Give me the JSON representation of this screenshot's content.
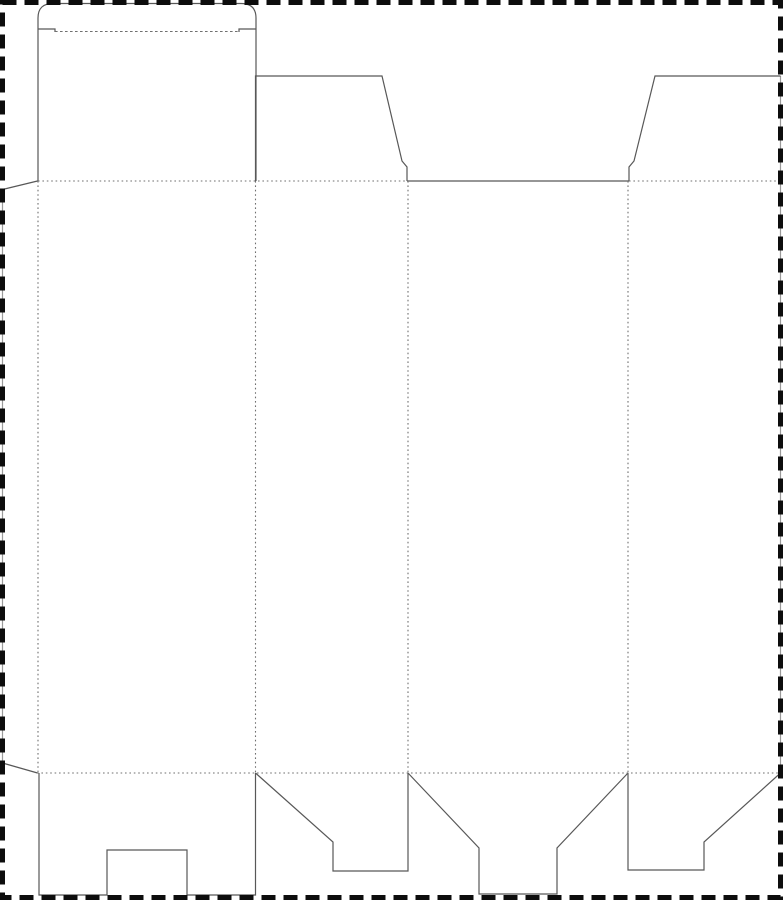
{
  "document": {
    "kind": "folding-carton-dieline-template",
    "description": "Blank box dieline: tuck-top lid with glue flap, four panels, dust flaps and notched bottom flap, surrounded by a dashed cut border"
  },
  "canvas": {
    "width": 783,
    "height": 900,
    "background": "#ffffff"
  },
  "styles": {
    "cut_color": "#585858",
    "cut_width": 1.2,
    "fold_color": "#6f6f6f",
    "fold_width": 1.1,
    "fold_dash": "1.6 2.8",
    "tuck_fold_dash": "2.6 2.4",
    "clipped_color": "#9a9a9a",
    "clipped_width": 1.2,
    "border_color": "#0d0d0d",
    "border_width": 5,
    "border_dash": "14 8"
  },
  "border": {
    "x": 2.5,
    "y": 2.5,
    "width": 778,
    "height": 895
  },
  "clipped_edges": [
    {
      "name": "glue-flap-clipped-left-edge",
      "d": "M 2.5 189 L 2.5 763"
    },
    {
      "name": "right-panel-clipped-edge",
      "d": "M 780.5 76 L 780.5 773"
    }
  ],
  "cut_paths": [
    {
      "name": "tuck-lid-outline",
      "d": "M 38 181 L 38 18 Q 38 3.5 53 3.5 L 241 3.5 Q 256 3.5 256 18 L 256 181"
    },
    {
      "name": "tuck-shoulder-left",
      "d": "M 38 29 L 55 29 L 55 32"
    },
    {
      "name": "tuck-shoulder-right",
      "d": "M 239 32 L 239 29 L 256 29"
    },
    {
      "name": "glue-flap-top-edge",
      "d": "M 2.5 189.5 L 37.5 181"
    },
    {
      "name": "glue-flap-bottom-edge",
      "d": "M 2.5 763 L 37.5 773"
    },
    {
      "name": "top-dust-flap-left",
      "d": "M 255.5 181 L 255.5 76 L 382 76 L 402 161 L 407 167 L 407 181"
    },
    {
      "name": "back-panel-top-cut-edge",
      "d": "M 407 181 L 629 181"
    },
    {
      "name": "top-dust-flap-right",
      "d": "M 629 181 L 629 167 L 634 161 L 655 76 L 780.5 76"
    },
    {
      "name": "bottom-flap-notched",
      "d": "M 39 773 L 39 895 L 107 895 L 107 850 L 187 850 L 187 895 L 255.5 895 L 255.5 773"
    },
    {
      "name": "bottom-dust-flap-left",
      "d": "M 255.5 773 L 333 842 L 333 871 L 408 871 L 408 773"
    },
    {
      "name": "bottom-tuck-flap",
      "d": "M 408 773 L 479 848 L 479 894 L 557 894 L 557 848 L 628 773"
    },
    {
      "name": "bottom-dust-flap-right",
      "d": "M 628 773 L 628 870 L 704 870 L 704 842 L 780.5 773"
    }
  ],
  "fold_lines": [
    {
      "name": "tuck-flap-fold",
      "d": "M 55 31.5 L 239 31.5",
      "style": "tuck"
    },
    {
      "name": "top-fold-left-segment",
      "d": "M 38 181 L 407 181"
    },
    {
      "name": "top-fold-right-segment",
      "d": "M 629 181 L 780.5 181"
    },
    {
      "name": "bottom-fold",
      "d": "M 37 773 L 780.5 773"
    },
    {
      "name": "glue-flap-fold",
      "d": "M 38 181 L 38 773"
    },
    {
      "name": "panel-fold-front-side",
      "d": "M 255.5 181 L 255.5 773"
    },
    {
      "name": "panel-fold-side-back",
      "d": "M 408 181 L 408 773"
    },
    {
      "name": "panel-fold-back-side",
      "d": "M 628 181 L 628 773"
    }
  ]
}
